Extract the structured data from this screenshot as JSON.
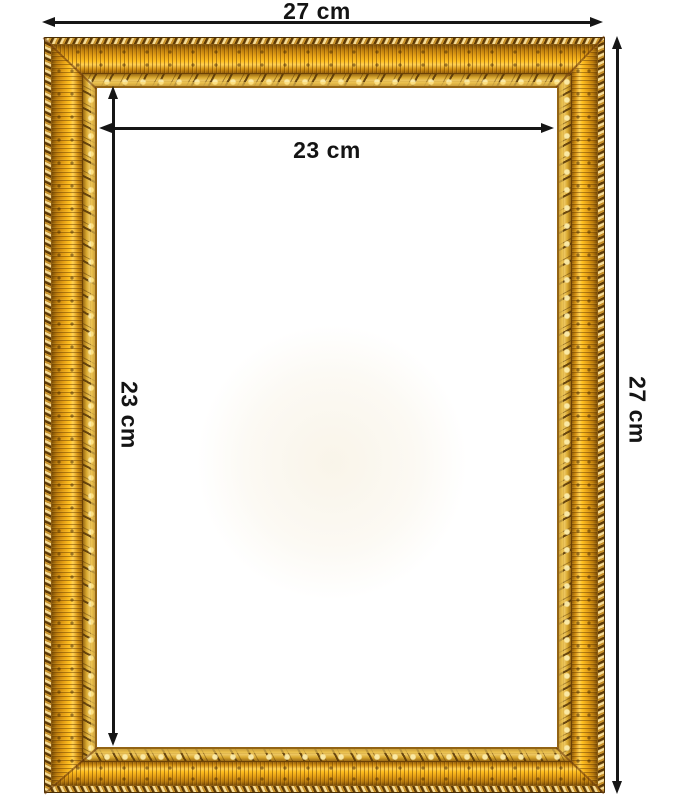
{
  "diagram": {
    "type": "product-dimension-image",
    "subject": "ornate golden picture frame",
    "background_color": "#ffffff",
    "arrow_color": "#161616",
    "label_color": "#141414"
  },
  "dimensions": {
    "outer_width": {
      "label": "27 cm",
      "orientation": "horizontal",
      "position": "above-frame"
    },
    "outer_height": {
      "label": "27 cm",
      "orientation": "vertical",
      "position": "right-of-frame"
    },
    "inner_width": {
      "label": "23 cm",
      "orientation": "horizontal",
      "position": "inside-top"
    },
    "inner_height": {
      "label": "23 cm",
      "orientation": "vertical",
      "position": "inside-left"
    }
  },
  "frame": {
    "style": "ornate-gold",
    "colors": {
      "gold_bright": "#ffbe1e",
      "gold_highlight": "#ffd052",
      "amber_mid": "#e09a12",
      "amber_dark": "#7d4e05",
      "ornate_base": "#d9a82f",
      "ornate_light": "#eec863",
      "brown_deep": "#5e3a06",
      "rope_light": "#f6dc96"
    }
  }
}
